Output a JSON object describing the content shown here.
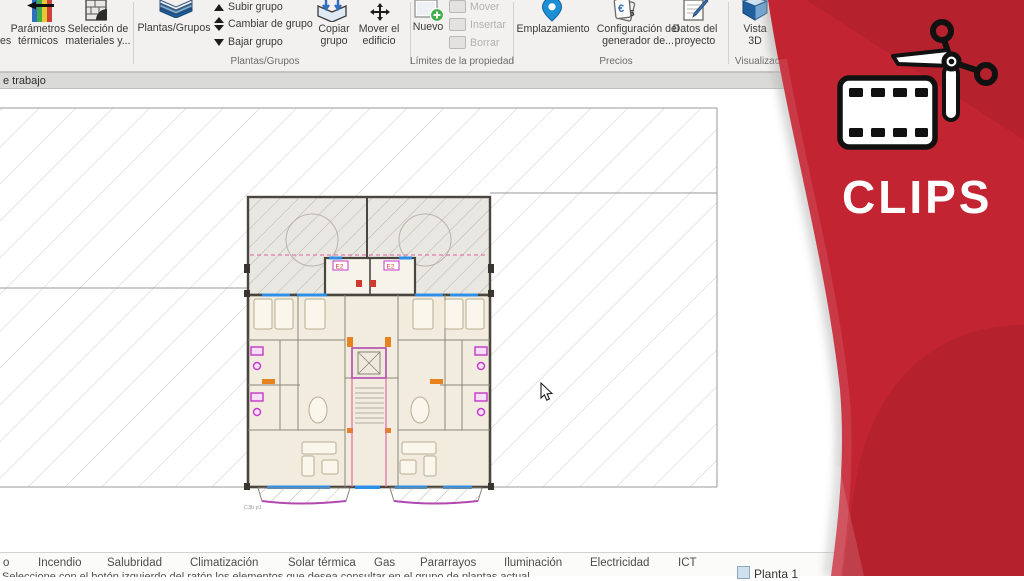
{
  "ribbon": {
    "cut_label": "es",
    "big_button": "Plantas/Grupos",
    "buttons": {
      "parametros": "Parámetros térmicos",
      "seleccion": "Selección de materiales y...",
      "subir": "Subir grupo",
      "cambiar": "Cambiar de grupo",
      "bajar": "Bajar grupo",
      "copiar": "Copiar grupo",
      "mover_edificio": "Mover el edificio",
      "nuevo": "Nuevo",
      "mover": "Mover",
      "insertar": "Insertar",
      "borrar": "Borrar",
      "emplazamiento": "Emplazamiento",
      "config_generador": "Configuración del generador de...",
      "datos_proyecto": "Datos del proyecto",
      "vista3d": "Vista 3D"
    },
    "groups": {
      "plantas": "Plantas/Grupos",
      "limites": "Límites de la propiedad",
      "precios": "Precios",
      "visualizacion": "Visualización"
    }
  },
  "workspace_bar": {
    "label": "e trabajo"
  },
  "plan": {
    "entry_label": "E2",
    "caption": "C3b p1"
  },
  "tabs": [
    "o",
    "Incendio",
    "Salubridad",
    "Climatización",
    "Solar térmica",
    "Gas",
    "Pararrayos",
    "Iluminación",
    "Electricidad",
    "ICT"
  ],
  "status": {
    "hint_partial": "Seleccione con el botón izquierdo del ratón los elementos que desea consultar en el grupo de plantas actual",
    "layer_label": "Planta 1"
  },
  "brand": {
    "title": "CLIPS"
  },
  "colors": {
    "brand_red": "#c32431",
    "accent_blue": "#2e6fbf",
    "pin_blue": "#1e8fd5",
    "window_blue": "#2e8fe8",
    "fixture_magenta": "#c238c8",
    "balcony_magenta": "#b04ab0",
    "door_orange": "#e8821e",
    "hatch_gray": "#cfcfcf",
    "wall_dark": "#4a463f",
    "green_plus": "#3fae49"
  }
}
